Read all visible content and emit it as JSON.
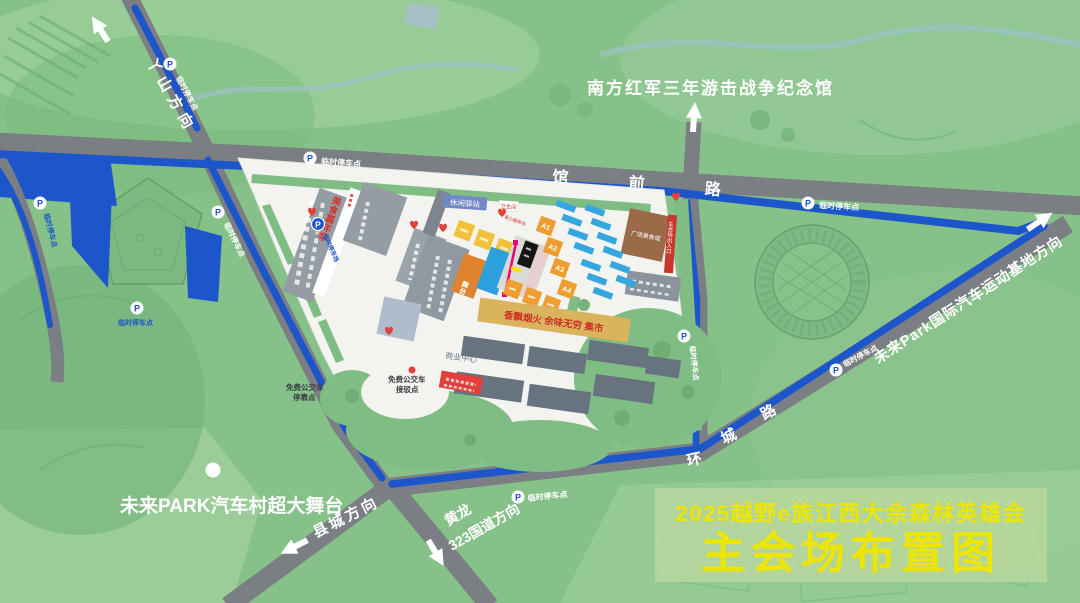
{
  "map_title": {
    "event": "2025越野e族江西大余森林英雄会",
    "name": "主会场布置图",
    "accent_color": "#ede600"
  },
  "landmarks": {
    "memorial": "南方红军三年游击战争纪念馆",
    "mega_stage": "未来PARK汽车村超大舞台"
  },
  "roads": {
    "guanqian": "馆 前 路",
    "huancheng_chars": [
      "环",
      "城",
      "路"
    ],
    "yashan_dir": "丫山方向",
    "xiancheng_dir": "县城方向",
    "huanglong_line1": "黄龙",
    "huanglong_line2": "323国道方向",
    "future_park_dir": "未来Park国际汽车运动基地方向"
  },
  "parking": {
    "p": "P",
    "temp_point": "临时停车点",
    "temp_lot": "临时停车场",
    "route_color": "#1d56cb"
  },
  "venue": {
    "rest_station": "休闲驿站",
    "toilet": "卫生间",
    "food_carnival": "美食嘉年华",
    "food_court": "广场美食城",
    "market_banner": "香飘烟火 余味无穷 集市",
    "business_center": "商业中心",
    "bus_stop_line1": "免费公交车",
    "bus_stop_line2": "停靠点",
    "bus_shuttle_line1": "免费公交车",
    "bus_shuttle_line2": "接驳点",
    "love_station": "爱心服务站",
    "stage": "舞台",
    "entrance": "主会场出入口",
    "zones": [
      "A1",
      "A2",
      "A3",
      "A4"
    ]
  }
}
